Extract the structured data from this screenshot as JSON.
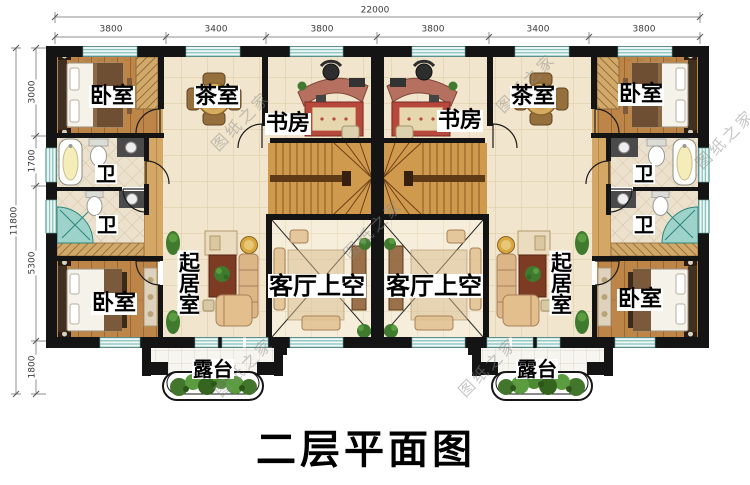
{
  "title": {
    "text": "二层平面图"
  },
  "watermark": {
    "text": "图纸之家"
  },
  "dimensions": {
    "top": {
      "total": "22000",
      "segments": [
        "3800",
        "3400",
        "3800",
        "3800",
        "3400",
        "3800"
      ]
    },
    "left": {
      "total": "11800",
      "segments": [
        "3000",
        "1700",
        "5300",
        "1800"
      ]
    }
  },
  "rooms": {
    "bedroom": "卧室",
    "tea_room": "茶室",
    "study": "书房",
    "bath": "卫",
    "living_room": "起居室",
    "living_void": "客厅上空",
    "terrace": "露台"
  },
  "colors": {
    "wall": "#141414",
    "window_glass": "#bfe4e1",
    "wood_floor": "#bd8547",
    "tile_floor": "#f1e6cd",
    "stair_wood": "#cf9a4e",
    "plant_green": "#4e8a33",
    "rug_red": "#b6483c",
    "title_text": "#000000"
  }
}
